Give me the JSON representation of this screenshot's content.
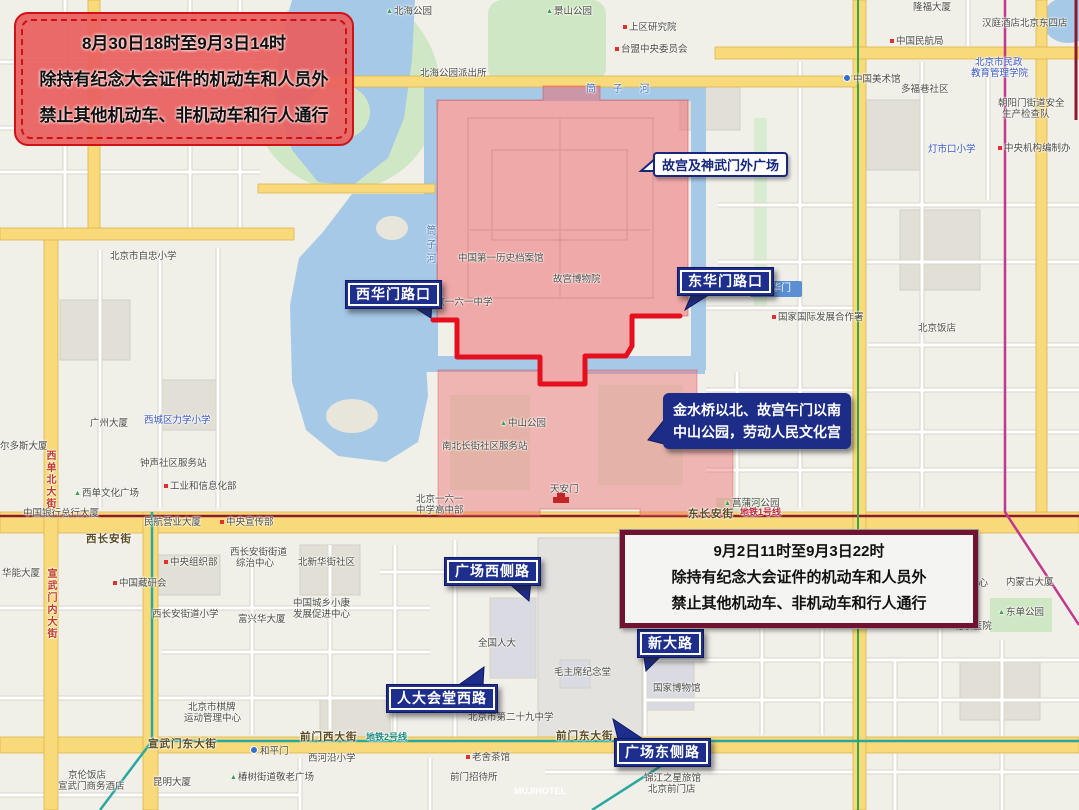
{
  "banners": {
    "top": {
      "lines": [
        "8月30日18时至9月3日14时",
        "除持有纪念大会证件的机动车和人员外",
        "禁止其他机动车、非机动车和行人通行"
      ]
    },
    "bottom": {
      "lines": [
        "9月2日11时至9月3日22时",
        "除持有纪念大会证件的机动车和人员外",
        "禁止其他机动车、非机动车和行人通行"
      ]
    }
  },
  "callouts": {
    "palace": {
      "text": "故宫及神武门外广场"
    },
    "south_zone": {
      "lines": [
        "金水桥以北、故宫午门以南",
        "中山公园，劳动人民文化宫"
      ]
    },
    "roads": [
      {
        "label": "西华门路口",
        "x": 345,
        "y": 280,
        "tail": "dr"
      },
      {
        "label": "东华门路口",
        "x": 677,
        "y": 267,
        "tail": "dl"
      },
      {
        "label": "广场西侧路",
        "x": 444,
        "y": 557,
        "tail": "dr"
      },
      {
        "label": "人大会堂西路",
        "x": 386,
        "y": 684,
        "tail": "ur"
      },
      {
        "label": "新大路",
        "x": 637,
        "y": 629,
        "tail": "dl"
      },
      {
        "label": "广场东侧路",
        "x": 614,
        "y": 738,
        "tail": "ul"
      }
    ]
  },
  "station_chip": {
    "text": "东华门"
  },
  "map": {
    "labels": [
      {
        "t": "北海公园",
        "x": 386,
        "y": 6,
        "c": "tree"
      },
      {
        "t": "景山公园",
        "x": 546,
        "y": 6,
        "c": "tree"
      },
      {
        "t": "上区研究院",
        "x": 623,
        "y": 22,
        "c": "poi-red"
      },
      {
        "t": "台盟中央委员会",
        "x": 615,
        "y": 44,
        "c": "poi-red"
      },
      {
        "t": "北海公园派出所",
        "x": 420,
        "y": 68,
        "c": "poi"
      },
      {
        "t": "筒 子 河",
        "x": 586,
        "y": 84,
        "c": "water-h"
      },
      {
        "t": "隆福大厦",
        "x": 913,
        "y": 2,
        "c": "poi"
      },
      {
        "t": "汉庭酒店北京东四店",
        "x": 982,
        "y": 18,
        "c": "poi"
      },
      {
        "t": "中国民航局",
        "x": 890,
        "y": 36,
        "c": "poi-red"
      },
      {
        "t": "中国美术馆",
        "x": 843,
        "y": 74,
        "c": "poi-metro"
      },
      {
        "t": "多福巷社区",
        "x": 901,
        "y": 84,
        "c": "poi"
      },
      {
        "t": "北京市民政",
        "x": 975,
        "y": 57,
        "c": "poi-blue"
      },
      {
        "t": "教育管理学院",
        "x": 971,
        "y": 68,
        "c": "poi-blue"
      },
      {
        "t": "朝阳门街道安全",
        "x": 998,
        "y": 98,
        "c": "poi"
      },
      {
        "t": "生产检查队",
        "x": 1002,
        "y": 109,
        "c": "poi"
      },
      {
        "t": "灯市口小学",
        "x": 928,
        "y": 144,
        "c": "poi-blue"
      },
      {
        "t": "中央机构编制办",
        "x": 998,
        "y": 143,
        "c": "poi-red"
      },
      {
        "t": "筒子河",
        "x": 424,
        "y": 225,
        "c": "water-v"
      },
      {
        "t": "北京市自忠小学",
        "x": 110,
        "y": 251,
        "c": "poi"
      },
      {
        "t": "中国第一历史档案馆",
        "x": 458,
        "y": 253,
        "c": "poi"
      },
      {
        "t": "故宫博物院",
        "x": 553,
        "y": 274,
        "c": "poi"
      },
      {
        "t": "北京一六一中学",
        "x": 426,
        "y": 297,
        "c": "poi"
      },
      {
        "t": "国家国际发展合作署",
        "x": 772,
        "y": 312,
        "c": "poi-red"
      },
      {
        "t": "北京饭店",
        "x": 918,
        "y": 323,
        "c": "poi"
      },
      {
        "t": "广州大厦",
        "x": 90,
        "y": 418,
        "c": "poi"
      },
      {
        "t": "西城区力学小学",
        "x": 144,
        "y": 415,
        "c": "poi-blue"
      },
      {
        "t": "钟声社区服务站",
        "x": 140,
        "y": 458,
        "c": "poi"
      },
      {
        "t": "工业和信息化部",
        "x": 164,
        "y": 481,
        "c": "poi-red"
      },
      {
        "t": "西单文化广场",
        "x": 74,
        "y": 488,
        "c": "tree"
      },
      {
        "t": "尔多斯大厦",
        "x": 0,
        "y": 441,
        "c": "poi"
      },
      {
        "t": "中国银行总行大厦",
        "x": 23,
        "y": 508,
        "c": "poi"
      },
      {
        "t": "西单北大街",
        "x": 44,
        "y": 450,
        "c": "road-v"
      },
      {
        "t": "宣武门内大街",
        "x": 45,
        "y": 568,
        "c": "road-v"
      },
      {
        "t": "民航营业大厦",
        "x": 144,
        "y": 517,
        "c": "poi"
      },
      {
        "t": "中央宣传部",
        "x": 220,
        "y": 517,
        "c": "poi-red"
      },
      {
        "t": "西长安街",
        "x": 86,
        "y": 534,
        "c": "roadname"
      },
      {
        "t": "东长安街",
        "x": 688,
        "y": 509,
        "c": "roadname"
      },
      {
        "t": "地铁1号线",
        "x": 740,
        "y": 507,
        "c": "metro-red"
      },
      {
        "t": "中央组织部",
        "x": 164,
        "y": 557,
        "c": "poi-red"
      },
      {
        "t": "西长安街街道",
        "x": 230,
        "y": 547,
        "c": "poi"
      },
      {
        "t": "综治中心",
        "x": 236,
        "y": 558,
        "c": "poi"
      },
      {
        "t": "北新华街社区",
        "x": 298,
        "y": 557,
        "c": "poi"
      },
      {
        "t": "华能大厦",
        "x": 2,
        "y": 568,
        "c": "poi"
      },
      {
        "t": "中国藏研会",
        "x": 113,
        "y": 578,
        "c": "poi-red"
      },
      {
        "t": "中国城乡小康",
        "x": 293,
        "y": 598,
        "c": "poi"
      },
      {
        "t": "发展促进中心",
        "x": 293,
        "y": 609,
        "c": "poi"
      },
      {
        "t": "富兴华大厦",
        "x": 238,
        "y": 614,
        "c": "poi"
      },
      {
        "t": "西长安街道小学",
        "x": 152,
        "y": 609,
        "c": "poi"
      },
      {
        "t": "中山公园",
        "x": 500,
        "y": 418,
        "c": "tree"
      },
      {
        "t": "南北长街社区服务站",
        "x": 442,
        "y": 441,
        "c": "poi"
      },
      {
        "t": "天安门",
        "x": 550,
        "y": 484,
        "c": "poi"
      },
      {
        "t": "北京一六一",
        "x": 416,
        "y": 494,
        "c": "poi"
      },
      {
        "t": "中学高中部",
        "x": 416,
        "y": 505,
        "c": "poi"
      },
      {
        "t": "菖蒲河公园",
        "x": 724,
        "y": 498,
        "c": "tree"
      },
      {
        "t": "全国人大",
        "x": 478,
        "y": 638,
        "c": "poi"
      },
      {
        "t": "毛主席纪念堂",
        "x": 554,
        "y": 667,
        "c": "poi"
      },
      {
        "t": "国家博物馆",
        "x": 653,
        "y": 683,
        "c": "poi"
      },
      {
        "t": "签证中心",
        "x": 950,
        "y": 578,
        "c": "poi"
      },
      {
        "t": "内蒙古大厦",
        "x": 1006,
        "y": 577,
        "c": "poi"
      },
      {
        "t": "东单公园",
        "x": 998,
        "y": 607,
        "c": "tree"
      },
      {
        "t": "北京医院",
        "x": 946,
        "y": 621,
        "c": "hospital"
      },
      {
        "t": "北京市棋牌",
        "x": 188,
        "y": 702,
        "c": "poi"
      },
      {
        "t": "运动管理中心",
        "x": 184,
        "y": 713,
        "c": "poi"
      },
      {
        "t": "北京市第二十九中学",
        "x": 468,
        "y": 712,
        "c": "poi"
      },
      {
        "t": "宣武门东大街",
        "x": 148,
        "y": 739,
        "c": "roadname"
      },
      {
        "t": "前门西大街",
        "x": 300,
        "y": 732,
        "c": "roadname"
      },
      {
        "t": "地铁2号线",
        "x": 366,
        "y": 732,
        "c": "metro-teal"
      },
      {
        "t": "前门东大街",
        "x": 556,
        "y": 731,
        "c": "roadname"
      },
      {
        "t": "和平门",
        "x": 250,
        "y": 746,
        "c": "poi-metro"
      },
      {
        "t": "京伦饭店",
        "x": 68,
        "y": 770,
        "c": "poi"
      },
      {
        "t": "宣武门商务酒店",
        "x": 58,
        "y": 781,
        "c": "poi"
      },
      {
        "t": "昆明大厦",
        "x": 153,
        "y": 777,
        "c": "poi"
      },
      {
        "t": "椿树街道敬老广场",
        "x": 230,
        "y": 772,
        "c": "tree"
      },
      {
        "t": "西河沿小学",
        "x": 308,
        "y": 753,
        "c": "poi"
      },
      {
        "t": "老舍茶馆",
        "x": 466,
        "y": 752,
        "c": "poi-red"
      },
      {
        "t": "前门招待所",
        "x": 450,
        "y": 772,
        "c": "poi"
      },
      {
        "t": "锦江之星旅馆",
        "x": 644,
        "y": 773,
        "c": "poi"
      },
      {
        "t": "北京前门店",
        "x": 648,
        "y": 784,
        "c": "poi"
      },
      {
        "t": "MUJIHOTEL",
        "x": 514,
        "y": 786,
        "c": "white-label"
      }
    ]
  },
  "colors": {
    "zone_red": "#ee6368",
    "route_red": "#e60f1e",
    "callout_navy": "#1d2e8c",
    "banner1_bg": "#ea5f5f",
    "banner1_border": "#d01217",
    "banner2_border": "#701332",
    "water": "#a6c9e8",
    "park": "#cfe7c4",
    "road_yellow": "#f8da7a",
    "metro1_red": "#8c1a2e",
    "metro2_teal": "#2aa8a0",
    "metro5_magenta": "#c0398f"
  }
}
